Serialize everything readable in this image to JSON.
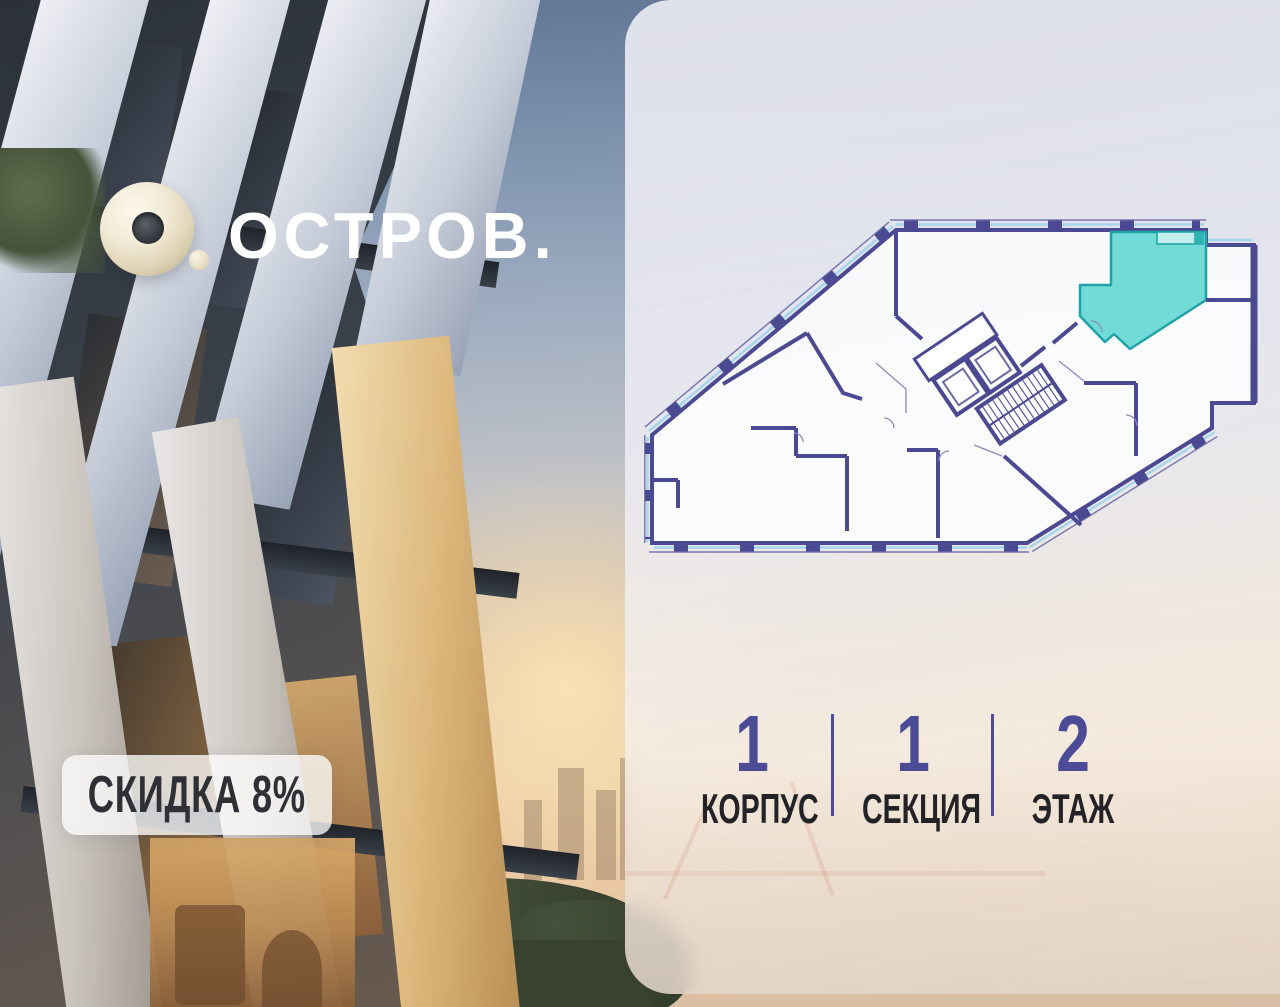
{
  "brand": {
    "logo_text": "ОСТРОВ."
  },
  "badge": {
    "label": "СКИДКА 8%"
  },
  "plan": {
    "highlight_color": "#72dbd7",
    "highlight_stroke": "#1ea3a6",
    "wall_color": "#4b4991",
    "glazing_color": "#a5d6ec",
    "outer_line_color": "#7b79ad"
  },
  "info": {
    "items": [
      {
        "value": "1",
        "label": "КОРПУС"
      },
      {
        "value": "1",
        "label": "СЕКЦИЯ"
      },
      {
        "value": "2",
        "label": "ЭТАЖ"
      }
    ]
  }
}
